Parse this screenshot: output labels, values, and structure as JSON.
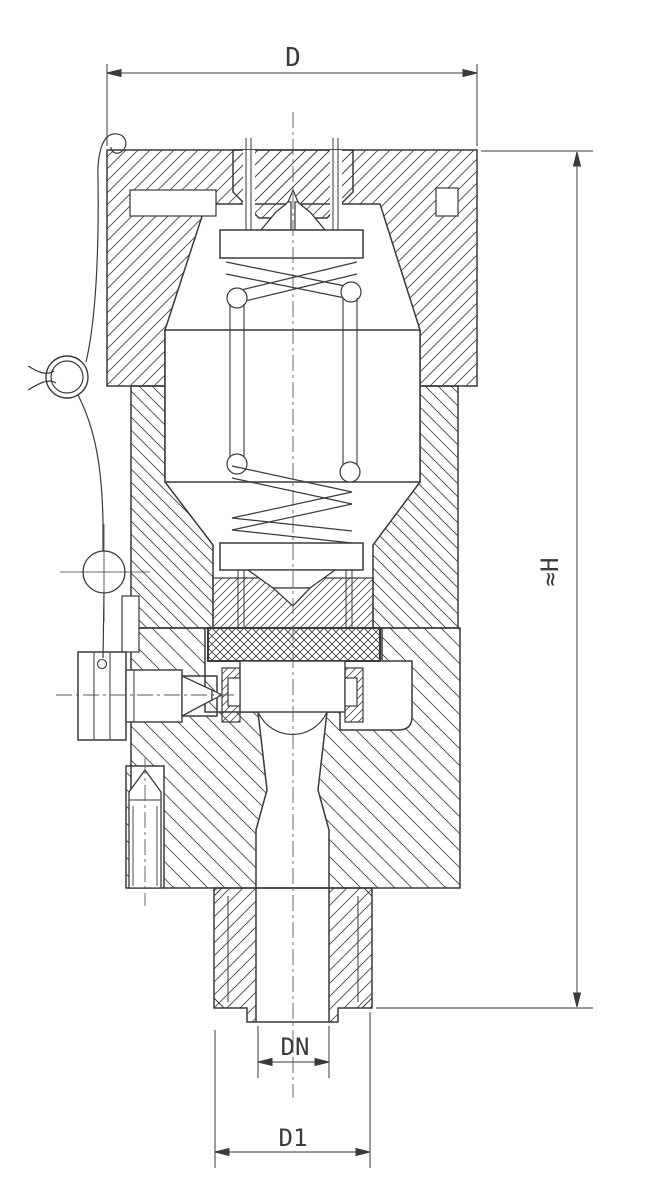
{
  "page": {
    "background": "#ffffff"
  },
  "drawing": {
    "type": "technical-section-drawing",
    "subject": "spring-loaded safety relief valve cross-section",
    "line_color": "#3a3a3a",
    "dimensions": {
      "d_label": "D",
      "h_label": "≈H",
      "dn_label": "DN",
      "d1_label": "D1"
    }
  }
}
